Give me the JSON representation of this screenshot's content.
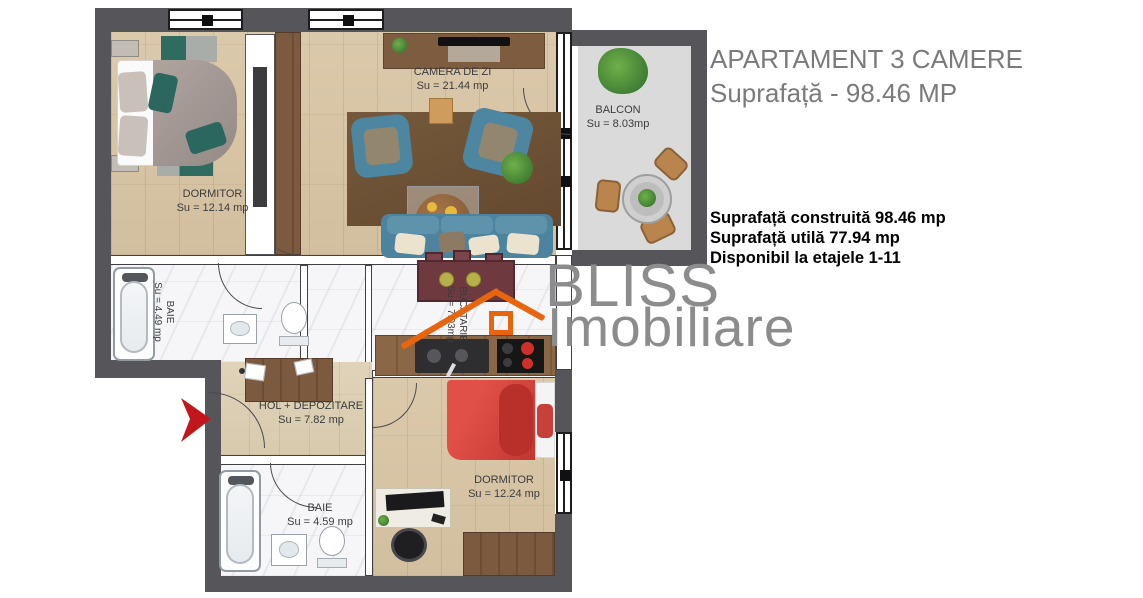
{
  "header": {
    "title": "APARTAMENT 3 CAMERE",
    "subtitle": "Suprafață - 98.46 MP"
  },
  "details": {
    "lines": [
      "Suprafață construită 98.46 mp",
      "Suprafață utilă 77.94 mp",
      "Disponibil la etajele 1-11"
    ]
  },
  "watermark": {
    "line1": "BLISS",
    "line2": "Imobiliare"
  },
  "rooms": [
    {
      "id": "dormitor-1",
      "name": "DORMITOR",
      "area": "Su = 12.14 mp"
    },
    {
      "id": "camera-de-zi",
      "name": "CAMERA DE ZI",
      "area": "Su = 21.44 mp"
    },
    {
      "id": "balcon",
      "name": "BALCON",
      "area": "Su = 8.03mp"
    },
    {
      "id": "baie-1",
      "name": "BAIE",
      "area": "Su = 4.49 mp"
    },
    {
      "id": "bucatarie",
      "name": "BUCATARIE",
      "area": "Su = 7.03mp"
    },
    {
      "id": "hol",
      "name": "HOL + DEPOZITARE",
      "area": "Su = 7.82 mp"
    },
    {
      "id": "baie-2",
      "name": "BAIE",
      "area": "Su = 4.59 mp"
    },
    {
      "id": "dormitor-2",
      "name": "DORMITOR",
      "area": "Su = 12.24 mp"
    }
  ],
  "colors": {
    "wall": "#56565a",
    "accent_logo": "#e8650f",
    "title_gray": "#7a7a7a",
    "watermark_gray": "#8c8c8c",
    "entrance_arrow": "#c0161c"
  }
}
